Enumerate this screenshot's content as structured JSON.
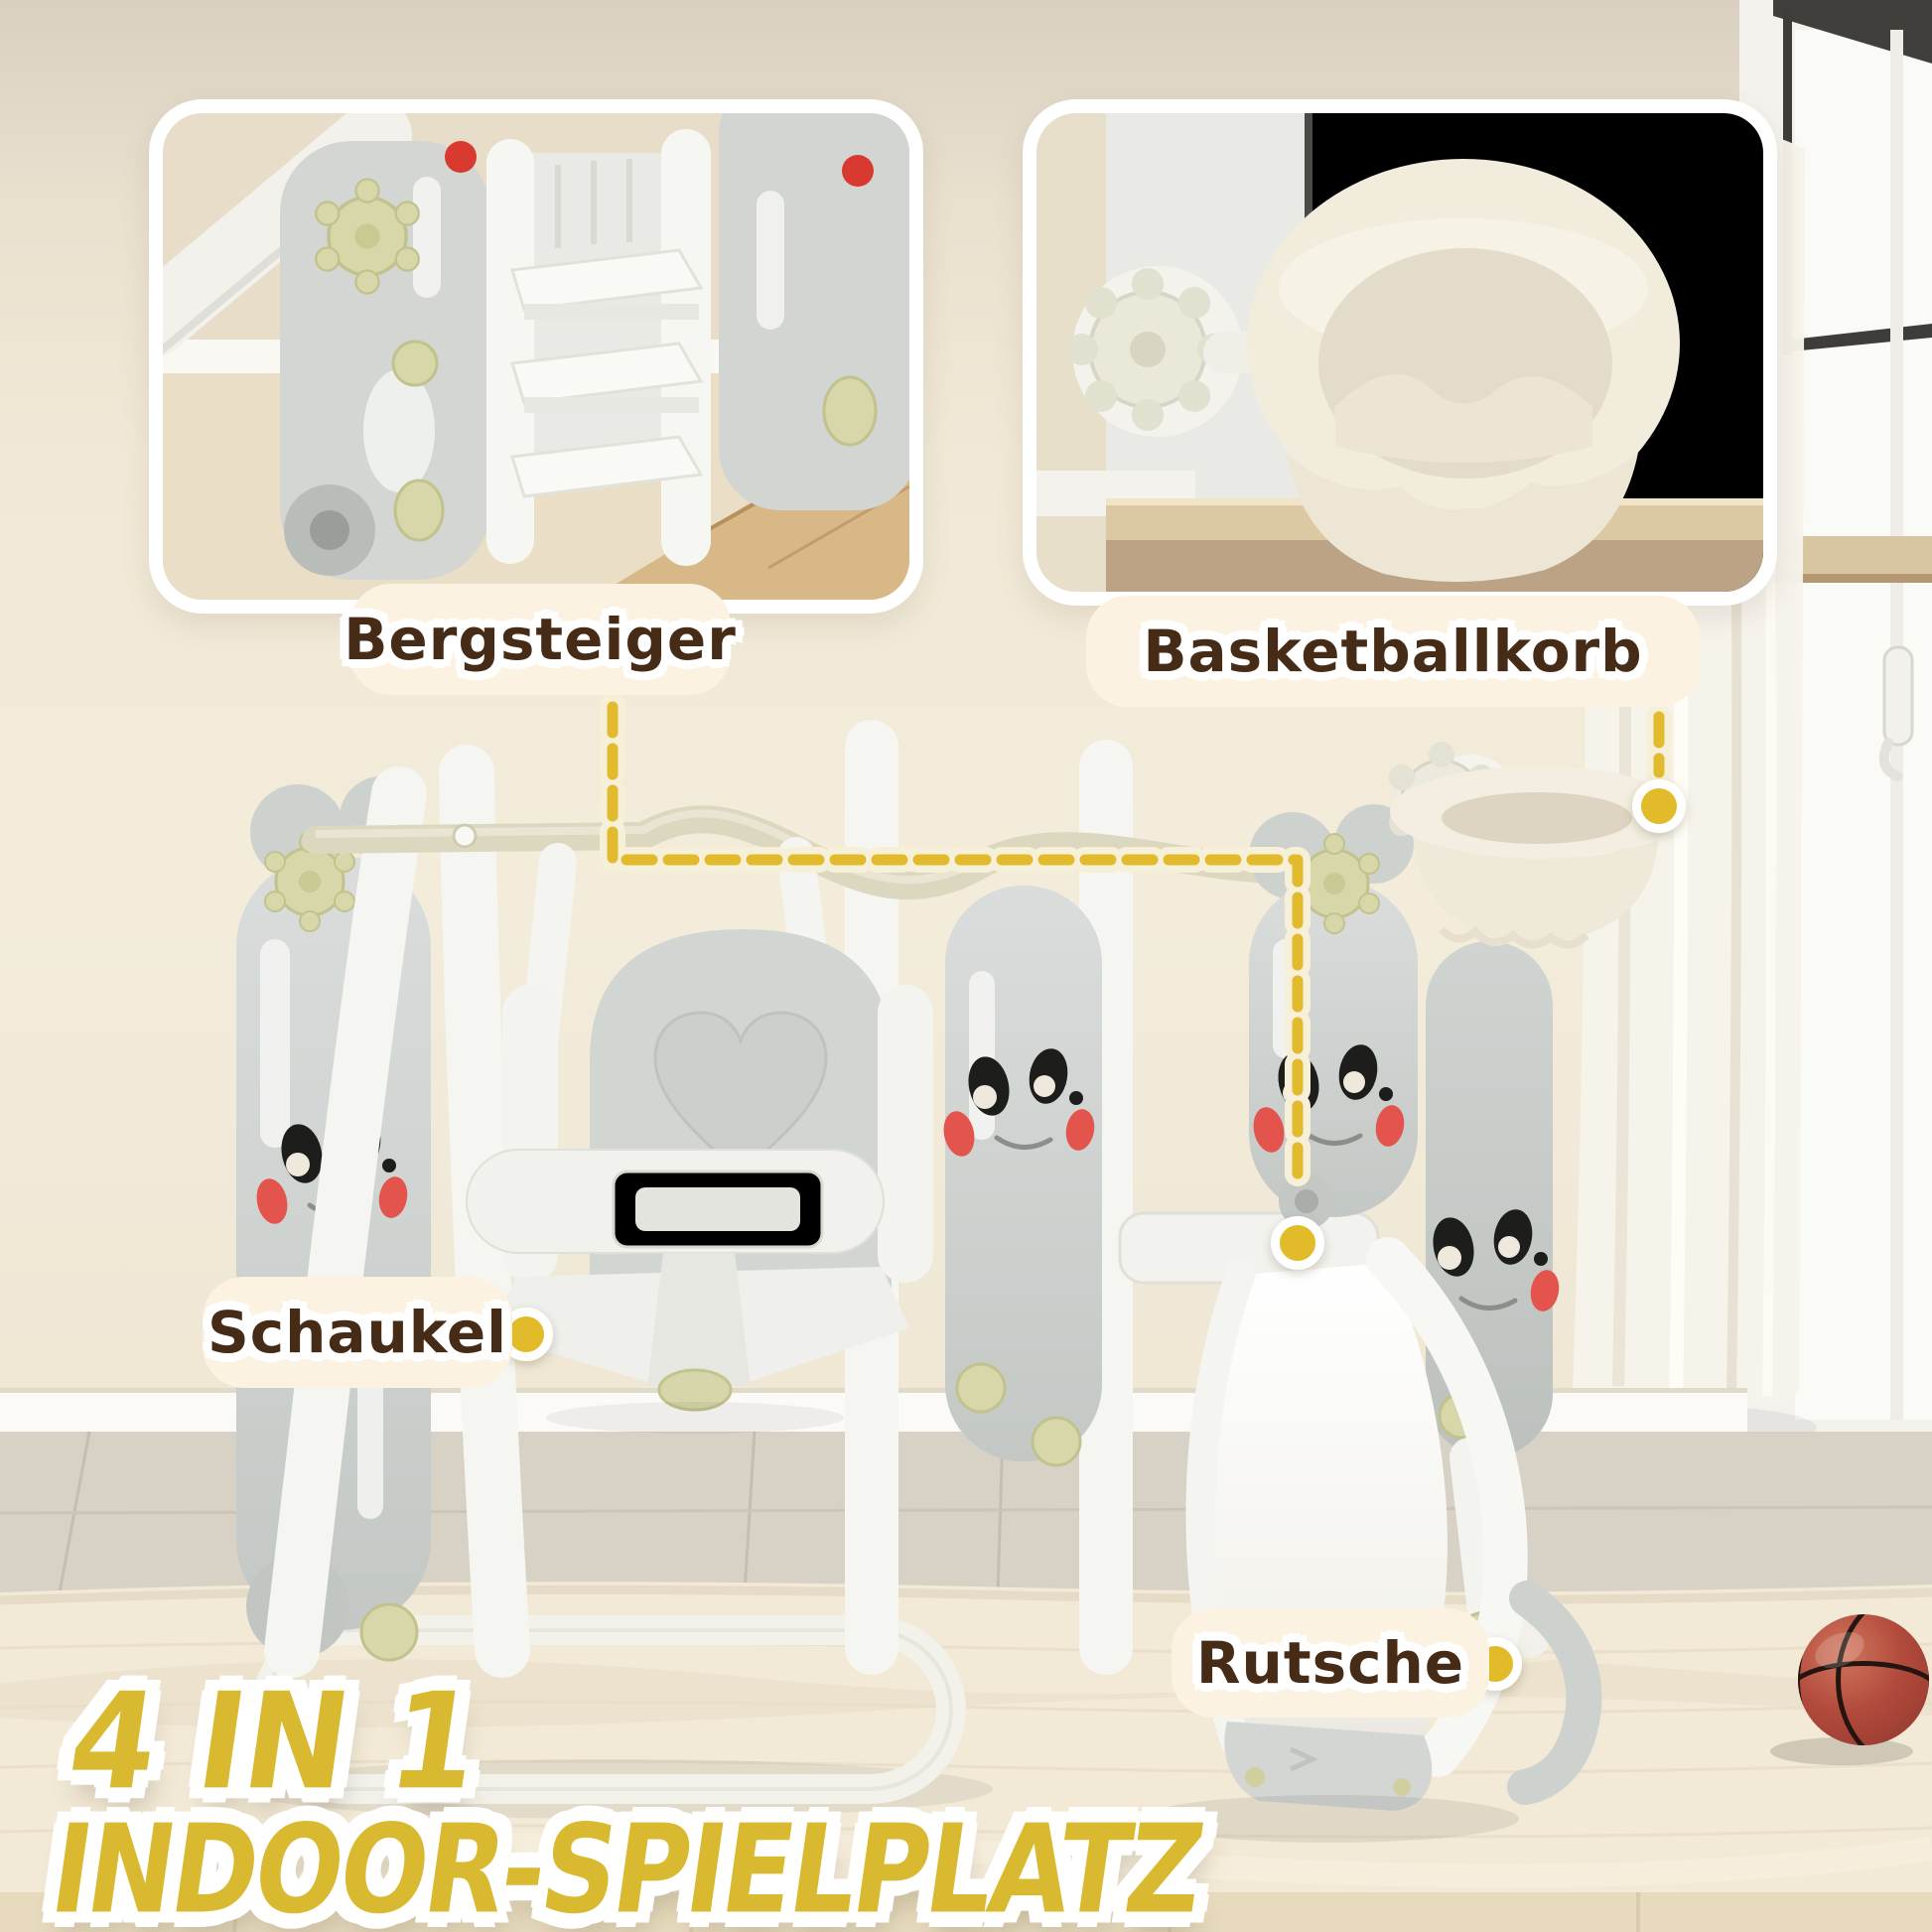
{
  "title": {
    "line1": "4 IN 1",
    "line2": "INDOOR-SPIELPLATZ"
  },
  "callouts": {
    "bergsteiger": {
      "label": "Bergsteiger"
    },
    "basketballkorb": {
      "label": "Basketballkorb"
    },
    "schaukel": {
      "label": "Schaukel"
    },
    "rutsche": {
      "label": "Rutsche"
    }
  },
  "icons": {
    "callout_dot": "yellow-circle-with-white-ring",
    "connector": "yellow-dashed-line"
  },
  "colors": {
    "background_wall": "#efe7d5",
    "wall_top_band": "#d9d0c2",
    "carpet": "#f2e9d6",
    "wood_floor": "#d9d2c6",
    "label_background": "#fcf2e1",
    "label_text": "#462b17",
    "accent_yellow_dash": "#e2ba2e",
    "dash_halo": "#f7f0d8",
    "title_yellow": "#d8b930",
    "plastic_white": "#f5f5f1",
    "plastic_grey": "#d5d8d5",
    "cap_green": "#d7d7aa",
    "cheek_red": "#e2544c",
    "ball_red": "#b24a3c"
  }
}
